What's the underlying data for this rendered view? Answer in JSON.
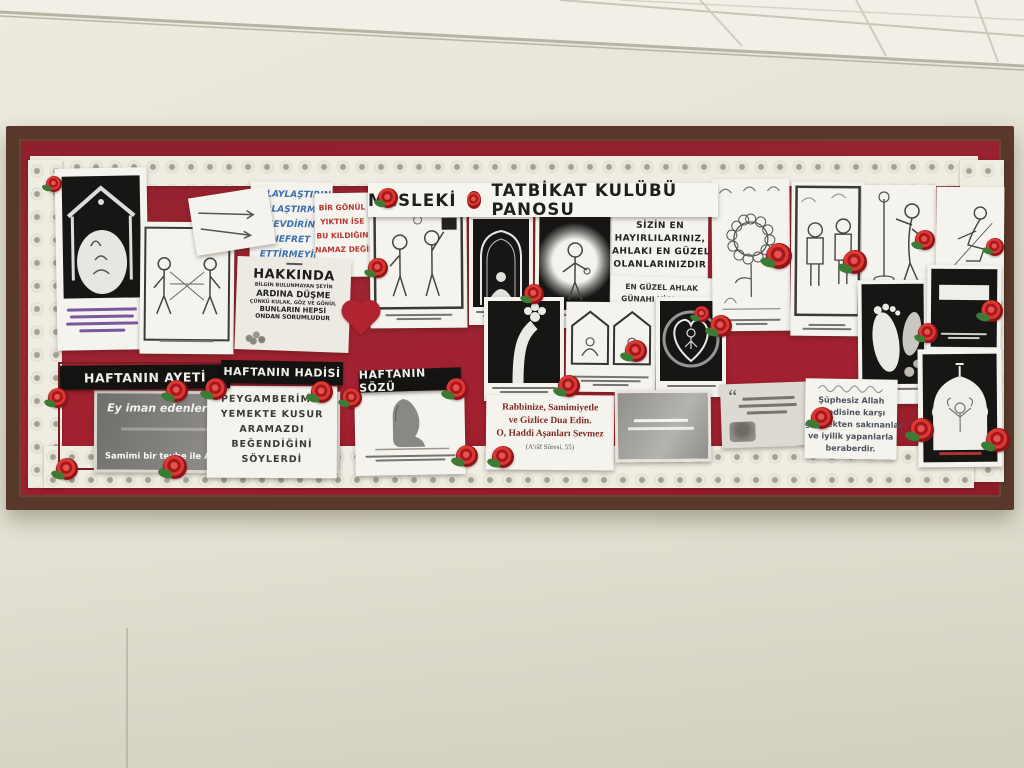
{
  "title": {
    "left": "MESLEKİ",
    "right": "TATBİKAT KULÜBÜ PANOSU"
  },
  "sections": {
    "ayet": "HAFTANIN AYETİ",
    "hadis": "HAFTANIN HADİSİ",
    "soz": "HAFTANIN SÖZÜ"
  },
  "ayet_card": {
    "line1": "Ey iman edenler!",
    "line2": "Samimi bir tevbe ile ALLAH'a dönün"
  },
  "hadis_card": {
    "lines": [
      "PEYGAMBERİMİZ",
      "YEMEKTE KUSUR",
      "ARAMAZDI",
      "BEĞENDİĞİNİ",
      "SÖYLERDİ"
    ]
  },
  "kolay_note": {
    "lines": [
      "KOLAYLAŞTIRIN",
      "ZORLAŞTIRMAYIN",
      "SEVDİRİN",
      "NEFRET",
      "ETTİRMEYİN"
    ]
  },
  "gonul_note": {
    "lines": [
      "BİR GÖNÜL",
      "YIKTIN İSE",
      "BU KILDIĞIN",
      "NAMAZ DEĞİL"
    ]
  },
  "hakkinda_card": {
    "lines": [
      "HAKKINDA",
      "BİLGİN BULUNMAYAN ŞEYİN",
      "ARDINA DÜŞME",
      "ÇÜNKÜ KULAK, GÖZ VE GÖNÜL",
      "BUNLARIN HEPSİ",
      "ONDAN SORUMLUDUR"
    ]
  },
  "sizin_note": {
    "lines": [
      "SİZİN EN",
      "HAYIRLILARINIZ,",
      "AHLAKI EN GÜZEL",
      "OLANLARINIZDIR"
    ]
  },
  "ahlak_note": {
    "lines": [
      "EN GÜZEL AHLAK",
      "GÜNAHI VİCDANINI",
      "RAHATSIZ EDEN VE",
      "İNSANLARIN BİRİSİNİ",
      "SEVMEKTİR"
    ]
  },
  "dua_card": {
    "lines": [
      "Rabbinize, Samimiyetle",
      "ve Gizlice Dua Edin.",
      "O, Haddi Aşanları Sevmez",
      "(A'râf Sûresi, 55)"
    ]
  },
  "sakinanlar_card": {
    "lines": [
      "Şüphesiz Allah",
      "kendisine karşı",
      "gelmekten sakınanlar",
      "ve iyilik yapanlarla",
      "beraberdir."
    ]
  },
  "quote_card": {
    "mark": "“"
  },
  "colors": {
    "board_frame": "#57382a",
    "backing_red": "#9c2431",
    "rose_red": "#c4242c",
    "leaf_green": "#3c7a36"
  }
}
